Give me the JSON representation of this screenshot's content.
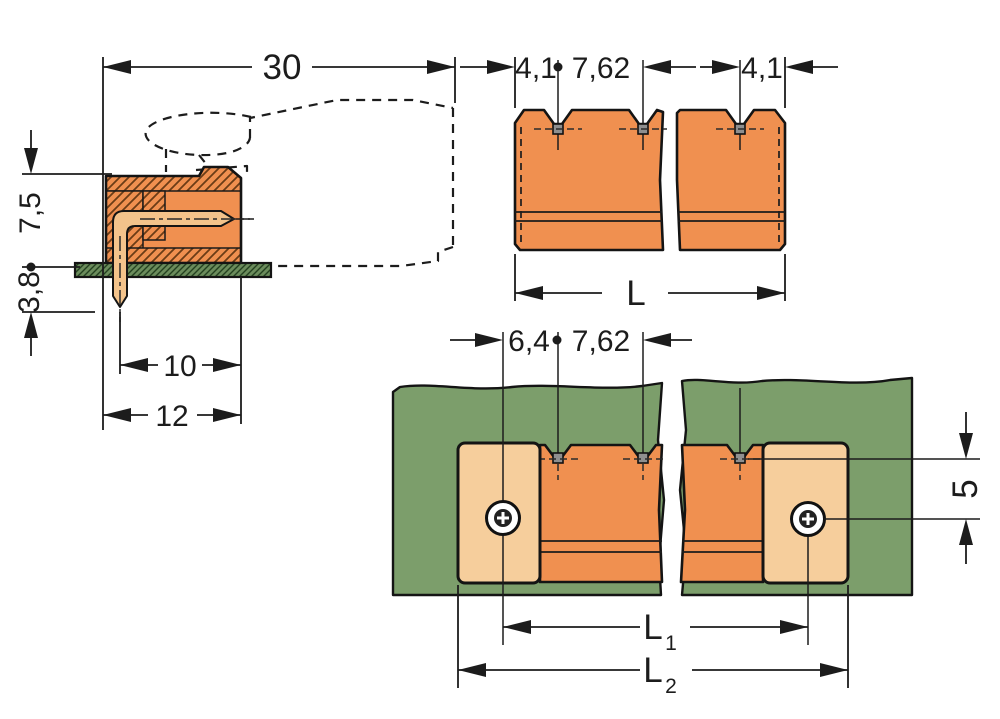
{
  "drawing": {
    "title": "connector-dimension-drawing",
    "side_view": {
      "dim_total_depth": "30",
      "dim_height_above_pcb": "7,5",
      "dim_pin_length_below": "3,8",
      "dim_pin_to_front": "10",
      "dim_body_depth": "12"
    },
    "top_view": {
      "dim_edge_to_pin": "4,1",
      "dim_pin_pitch": "7,62",
      "dim_pin_to_edge": "4,1",
      "dim_total_length": "L"
    },
    "bottom_view": {
      "dim_screw_to_pin": "6,4",
      "dim_pin_pitch": "7,62",
      "dim_pin_row_to_screw_row": "5",
      "dim_l1_base": "L",
      "dim_l1_sub": "1",
      "dim_l2_base": "L",
      "dim_l2_sub": "2"
    },
    "colors": {
      "body_orange": "#F09050",
      "flange_tan": "#F6CE9C",
      "pin_tan": "#F3C38B",
      "pcb_green": "#7C9E6B",
      "pcb_green_dark": "#6B8C5C",
      "hatch_brown": "#6b3c16",
      "outline": "#1a1a1a",
      "pin_square_grey": "#8f8f8f"
    }
  }
}
